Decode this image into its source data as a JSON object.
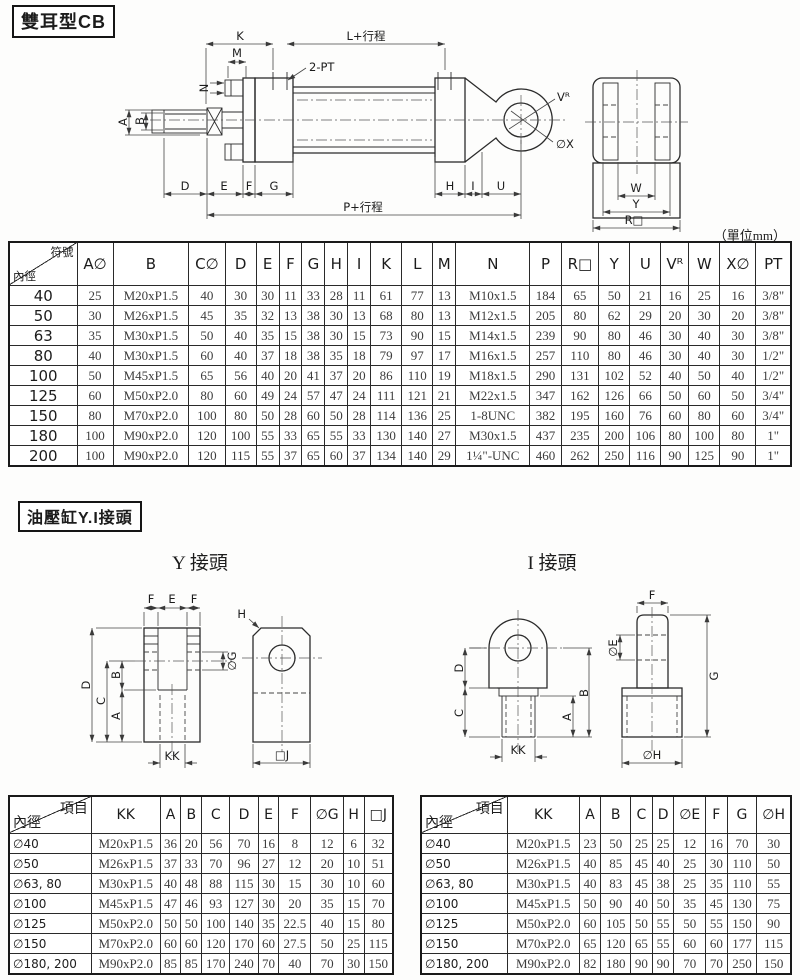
{
  "unit_note": "（單位mm）",
  "section1": {
    "title": "雙耳型CB",
    "labels": {
      "K": "K",
      "L": "L+行程",
      "M": "M",
      "N": "N",
      "PT2": "2-PT",
      "A": "A",
      "B": "B",
      "D": "D",
      "E": "E",
      "F": "F",
      "G": "G",
      "H": "H",
      "I": "I",
      "U": "U",
      "P": "P+行程",
      "VR": "Vᴿ",
      "OX": "∅X",
      "W": "W",
      "Y": "Y",
      "RSQ": "R□"
    },
    "table": {
      "corner_top": "符號",
      "corner_bottom": "內徑",
      "columns": [
        "A∅",
        "B",
        "C∅",
        "D",
        "E",
        "F",
        "G",
        "H",
        "I",
        "K",
        "L",
        "M",
        "N",
        "P",
        "R□",
        "Y",
        "U",
        "Vᴿ",
        "W",
        "X∅",
        "PT"
      ],
      "rows": [
        {
          "bore": "40",
          "values": [
            "25",
            "M20xP1.5",
            "40",
            "30",
            "30",
            "11",
            "33",
            "28",
            "11",
            "61",
            "77",
            "13",
            "M10x1.5",
            "184",
            "65",
            "50",
            "21",
            "16",
            "25",
            "16",
            "3/8\""
          ]
        },
        {
          "bore": "50",
          "values": [
            "30",
            "M26xP1.5",
            "45",
            "35",
            "32",
            "13",
            "38",
            "30",
            "13",
            "68",
            "80",
            "13",
            "M12x1.5",
            "205",
            "80",
            "62",
            "29",
            "20",
            "30",
            "20",
            "3/8\""
          ]
        },
        {
          "bore": "63",
          "values": [
            "35",
            "M30xP1.5",
            "50",
            "40",
            "35",
            "15",
            "38",
            "30",
            "15",
            "73",
            "90",
            "15",
            "M14x1.5",
            "239",
            "90",
            "80",
            "46",
            "30",
            "40",
            "30",
            "3/8\""
          ]
        },
        {
          "bore": "80",
          "values": [
            "40",
            "M30xP1.5",
            "60",
            "40",
            "37",
            "18",
            "38",
            "35",
            "18",
            "79",
            "97",
            "17",
            "M16x1.5",
            "257",
            "110",
            "80",
            "46",
            "30",
            "40",
            "30",
            "1/2\""
          ]
        },
        {
          "bore": "100",
          "values": [
            "50",
            "M45xP1.5",
            "65",
            "56",
            "40",
            "20",
            "41",
            "37",
            "20",
            "86",
            "110",
            "19",
            "M18x1.5",
            "290",
            "131",
            "102",
            "52",
            "40",
            "50",
            "40",
            "1/2\""
          ]
        },
        {
          "bore": "125",
          "values": [
            "60",
            "M50xP2.0",
            "80",
            "60",
            "49",
            "24",
            "57",
            "47",
            "24",
            "111",
            "121",
            "21",
            "M22x1.5",
            "347",
            "162",
            "126",
            "66",
            "50",
            "60",
            "50",
            "3/4\""
          ]
        },
        {
          "bore": "150",
          "values": [
            "80",
            "M70xP2.0",
            "100",
            "80",
            "50",
            "28",
            "60",
            "50",
            "28",
            "114",
            "136",
            "25",
            "1-8UNC",
            "382",
            "195",
            "160",
            "76",
            "60",
            "80",
            "60",
            "3/4\""
          ]
        },
        {
          "bore": "180",
          "values": [
            "100",
            "M90xP2.0",
            "120",
            "100",
            "55",
            "33",
            "65",
            "55",
            "33",
            "130",
            "140",
            "27",
            "M30x1.5",
            "437",
            "235",
            "200",
            "106",
            "80",
            "100",
            "80",
            "1\""
          ]
        },
        {
          "bore": "200",
          "values": [
            "100",
            "M90xP2.0",
            "120",
            "115",
            "55",
            "37",
            "65",
            "60",
            "37",
            "134",
            "140",
            "29",
            "1¼\"-UNC",
            "460",
            "262",
            "250",
            "116",
            "90",
            "125",
            "90",
            "1\""
          ]
        }
      ]
    }
  },
  "section2": {
    "title": "油壓缸Y.I接頭",
    "y_joint": {
      "subtitle": "Y 接頭",
      "labels": {
        "F": "F",
        "E": "E",
        "D": "D",
        "C": "C",
        "B": "B",
        "A": "A",
        "OG": "∅G",
        "KK": "KK",
        "H": "H",
        "J": "□J"
      },
      "table": {
        "corner_top": "項目",
        "corner_bottom": "內徑",
        "columns": [
          "KK",
          "A",
          "B",
          "C",
          "D",
          "E",
          "F",
          "∅G",
          "H",
          "□J"
        ],
        "rows": [
          {
            "bore": "∅40",
            "values": [
              "M20xP1.5",
              "36",
              "20",
              "56",
              "70",
              "16",
              "8",
              "12",
              "6",
              "32"
            ]
          },
          {
            "bore": "∅50",
            "values": [
              "M26xP1.5",
              "37",
              "33",
              "70",
              "96",
              "27",
              "12",
              "20",
              "10",
              "51"
            ]
          },
          {
            "bore": "∅63, 80",
            "values": [
              "M30xP1.5",
              "40",
              "48",
              "88",
              "115",
              "30",
              "15",
              "30",
              "10",
              "60"
            ]
          },
          {
            "bore": "∅100",
            "values": [
              "M45xP1.5",
              "47",
              "46",
              "93",
              "127",
              "30",
              "20",
              "35",
              "15",
              "70"
            ]
          },
          {
            "bore": "∅125",
            "values": [
              "M50xP2.0",
              "50",
              "50",
              "100",
              "140",
              "35",
              "22.5",
              "40",
              "15",
              "80"
            ]
          },
          {
            "bore": "∅150",
            "values": [
              "M70xP2.0",
              "60",
              "60",
              "120",
              "170",
              "60",
              "27.5",
              "50",
              "25",
              "115"
            ]
          },
          {
            "bore": "∅180, 200",
            "values": [
              "M90xP2.0",
              "85",
              "85",
              "170",
              "240",
              "70",
              "40",
              "70",
              "30",
              "150"
            ]
          }
        ]
      }
    },
    "i_joint": {
      "subtitle": "I 接頭",
      "labels": {
        "F": "F",
        "OE": "∅E",
        "G": "G",
        "OH": "∅H",
        "D": "D",
        "C": "C",
        "B": "B",
        "A": "A",
        "KK": "KK"
      },
      "table": {
        "corner_top": "項目",
        "corner_bottom": "內徑",
        "columns": [
          "KK",
          "A",
          "B",
          "C",
          "D",
          "∅E",
          "F",
          "G",
          "∅H"
        ],
        "rows": [
          {
            "bore": "∅40",
            "values": [
              "M20xP1.5",
              "23",
              "50",
              "25",
              "25",
              "12",
              "16",
              "70",
              "30"
            ]
          },
          {
            "bore": "∅50",
            "values": [
              "M26xP1.5",
              "40",
              "85",
              "45",
              "40",
              "25",
              "30",
              "110",
              "50"
            ]
          },
          {
            "bore": "∅63, 80",
            "values": [
              "M30xP1.5",
              "40",
              "83",
              "45",
              "38",
              "25",
              "35",
              "110",
              "55"
            ]
          },
          {
            "bore": "∅100",
            "values": [
              "M45xP1.5",
              "50",
              "90",
              "40",
              "50",
              "35",
              "45",
              "130",
              "75"
            ]
          },
          {
            "bore": "∅125",
            "values": [
              "M50xP2.0",
              "60",
              "105",
              "50",
              "55",
              "50",
              "55",
              "150",
              "90"
            ]
          },
          {
            "bore": "∅150",
            "values": [
              "M70xP2.0",
              "65",
              "120",
              "65",
              "55",
              "60",
              "60",
              "177",
              "115"
            ]
          },
          {
            "bore": "∅180, 200",
            "values": [
              "M90xP2.0",
              "82",
              "180",
              "90",
              "90",
              "70",
              "70",
              "250",
              "150"
            ]
          }
        ]
      }
    }
  }
}
